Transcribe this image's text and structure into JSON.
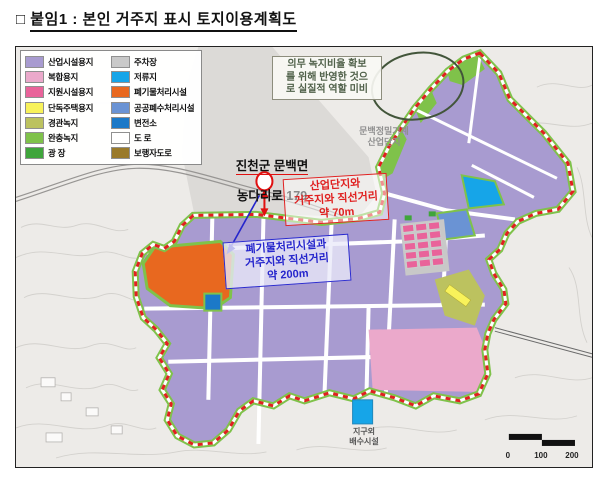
{
  "title": {
    "prefix": "□",
    "text": "붙임1 : 본인 거주지 표시 토지이용계획도"
  },
  "colors": {
    "industrial": "#a89bd0",
    "mixed": "#eba9cb",
    "support": "#e9639a",
    "housing": "#f8f25a",
    "landscape": "#bcc25f",
    "buffer": "#7fc24a",
    "plaza": "#3fa53b",
    "parking": "#c9c9c9",
    "retention": "#16a5e8",
    "waste": "#e8681f",
    "wastewater": "#6a93d4",
    "substation": "#1b79c8",
    "road": "#ffffff",
    "pedestrian": "#9a7a2a",
    "boundary_red": "#e02020",
    "marker_red": "#e01010",
    "note_blue": "#2525cc",
    "ellipse_green": "#42553a"
  },
  "legend": {
    "col1": [
      {
        "label": "산업시설용지",
        "color": "#a89bd0"
      },
      {
        "label": "복합용지",
        "color": "#eba9cb"
      },
      {
        "label": "지원시설용지",
        "color": "#e9639a"
      },
      {
        "label": "단독주택용지",
        "color": "#f8f25a"
      },
      {
        "label": "경관녹지",
        "color": "#bcc25f"
      },
      {
        "label": "완충녹지",
        "color": "#7fc24a"
      },
      {
        "label": "광 장",
        "color": "#3fa53b"
      }
    ],
    "col2": [
      {
        "label": "주차장",
        "color": "#c9c9c9"
      },
      {
        "label": "저류지",
        "color": "#16a5e8"
      },
      {
        "label": "폐기물처리시설",
        "color": "#e8681f"
      },
      {
        "label": "공공폐수처리시설",
        "color": "#6a93d4"
      },
      {
        "label": "변전소",
        "color": "#1b79c8"
      },
      {
        "label": "도 로",
        "color": "#ffffff"
      },
      {
        "label": "보행자도로",
        "color": "#9a7a2a"
      }
    ]
  },
  "annotations": {
    "green_note": "의무 녹지비율 확보\n를 위해 반영한 것으\n로 실질적 역할 미비",
    "complex_name": "문백정밀기계\n산업단지",
    "address_line1": "진천군 문백면",
    "address_line2": "농다리로 179",
    "industrial_distance_note": "산업단지와\n거주지와 직선거리\n약 70m",
    "waste_distance_note": "폐기물처리시설과\n거주지와 직선거리\n약 200m",
    "drainage_label": "지구외\n배수시설"
  },
  "scale_bar": {
    "labels": [
      "0",
      "100",
      "200"
    ]
  }
}
